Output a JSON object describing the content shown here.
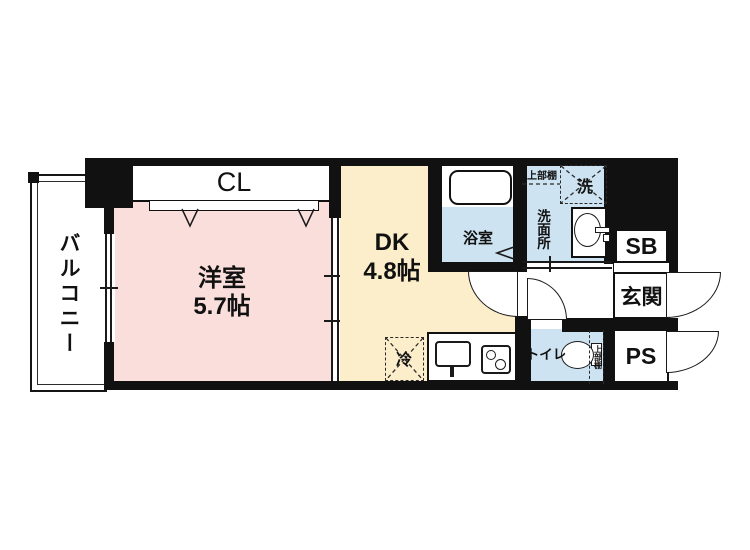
{
  "labels": {
    "balcony": "バルコニー",
    "closet": "CL",
    "western_room": "洋室",
    "western_room_size": "5.7帖",
    "dining_kitchen": "DK",
    "dining_kitchen_size": "4.8帖",
    "bathroom": "浴室",
    "washroom": "洗面所",
    "washing_machine": "洗",
    "upper_shelf_washroom": "上部棚",
    "shoe_box": "SB",
    "entrance": "玄関",
    "toilet": "トイレ",
    "upper_shelf_toilet": "上部棚",
    "pipe_space": "PS",
    "refrigerator": "冷"
  },
  "colors": {
    "wall": "#111111",
    "room-pink": "#f9dedb",
    "room-cream": "#fdeecb",
    "room-blue": "#cde3f1",
    "bg": "#ffffff"
  }
}
